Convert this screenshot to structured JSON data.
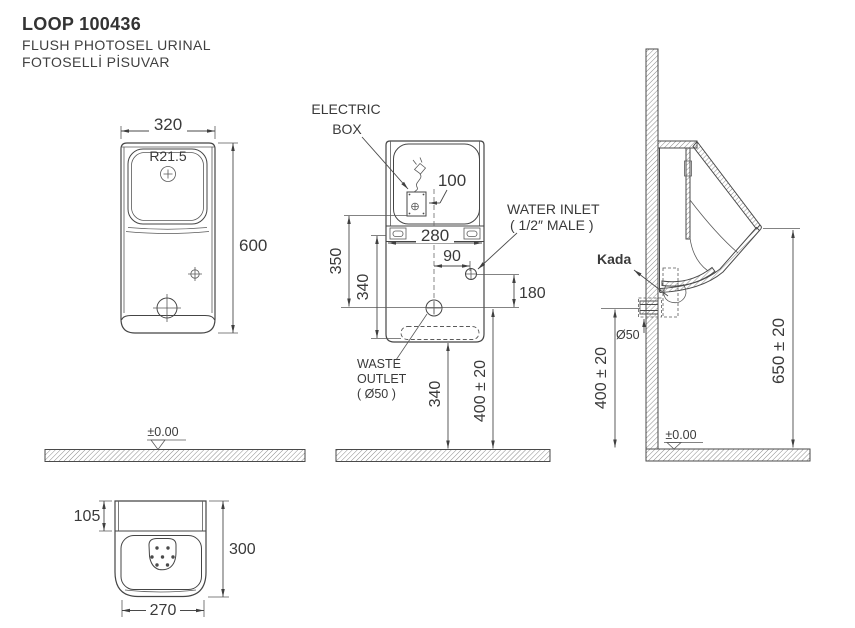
{
  "title": {
    "model": "LOOP 100436",
    "product_en": "FLUSH PHOTOSEL URINAL",
    "product_tr": "FOTOSELLİ PİSUVAR"
  },
  "front_view": {
    "width": "320",
    "height": "600",
    "corner_radius": "R21.5",
    "datum": "±0.00"
  },
  "rear_view": {
    "electric_box_label_1": "ELECTRIC",
    "electric_box_label_2": "BOX",
    "electric_box_offset": "100",
    "mounting_width": "280",
    "inlet_offset": "90",
    "inlet_to_waste": "180",
    "box_to_waste": "350",
    "rail_to_bottom": "340",
    "water_inlet_label_1": "WATER INLET",
    "water_inlet_label_2": "( 1/2″ MALE )",
    "waste_outlet_label_1": "WASTE",
    "waste_outlet_label_2": "OUTLET",
    "waste_outlet_label_3": "( Ø50 )",
    "floor_to_bottom": "340",
    "floor_to_waste": "400 ± 20"
  },
  "side_view": {
    "trap_label": "Kada",
    "outlet_diameter": "Ø50",
    "floor_to_outlet": "400 ± 20",
    "floor_to_rim": "650 ± 20",
    "datum": "±0.00"
  },
  "plan_view": {
    "top_depth": "105",
    "total_depth": "300",
    "bowl_width": "270"
  }
}
